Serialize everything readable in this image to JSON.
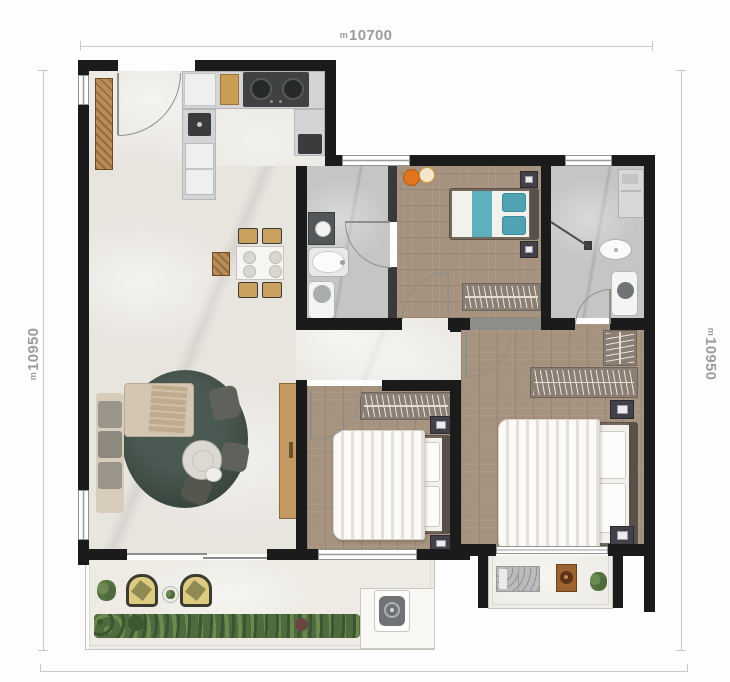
{
  "annotations": {
    "dim_top": {
      "prefix": "m",
      "value": "10700"
    },
    "dim_left": {
      "prefix": "m",
      "value": "10950"
    },
    "dim_right": {
      "prefix": "m",
      "value": "10950"
    }
  },
  "colors": {
    "wall": "#1b1b1b",
    "marble_floor": "#e8e5df",
    "wood_floor": "#a6937f",
    "bath_tile": "#c4c6c5",
    "rug": "#3e4b45",
    "teal_accent": "#5fb0bf",
    "wood_furniture": "#c49a62",
    "greenery": "#57713f",
    "dimension_text": "#9c9c9c"
  },
  "rooms": [
    {
      "name": "entry",
      "furniture": [
        "shoe-cabinet",
        "entrance-door"
      ]
    },
    {
      "name": "kitchen",
      "furniture": [
        "counter",
        "cooktop",
        "sink",
        "refrigerator",
        "cutting-board"
      ]
    },
    {
      "name": "living-dining",
      "furniture": [
        "dining-table",
        "dining-chairs",
        "side-cabinet",
        "round-rug",
        "sofa",
        "coffee-table",
        "armchairs",
        "tv-console"
      ]
    },
    {
      "name": "bathroom-1",
      "furniture": [
        "vanity",
        "bathtub",
        "toilet"
      ]
    },
    {
      "name": "bedroom-1",
      "furniture": [
        "bed-teal",
        "nightstands",
        "wardrobe",
        "fruit-decor"
      ]
    },
    {
      "name": "bathroom-2",
      "furniture": [
        "shower",
        "washbasin",
        "toilet",
        "vanity"
      ]
    },
    {
      "name": "bedroom-2",
      "furniture": [
        "double-bed",
        "nightstands",
        "wardrobe"
      ]
    },
    {
      "name": "master-bedroom",
      "furniture": [
        "double-bed",
        "nightstands",
        "l-wardrobe"
      ]
    },
    {
      "name": "balcony",
      "furniture": [
        "lounge-chairs",
        "plants",
        "hedge",
        "ac-unit"
      ]
    },
    {
      "name": "laundry-balcony",
      "furniture": [
        "washer-mat",
        "basin-board",
        "plant"
      ]
    }
  ]
}
